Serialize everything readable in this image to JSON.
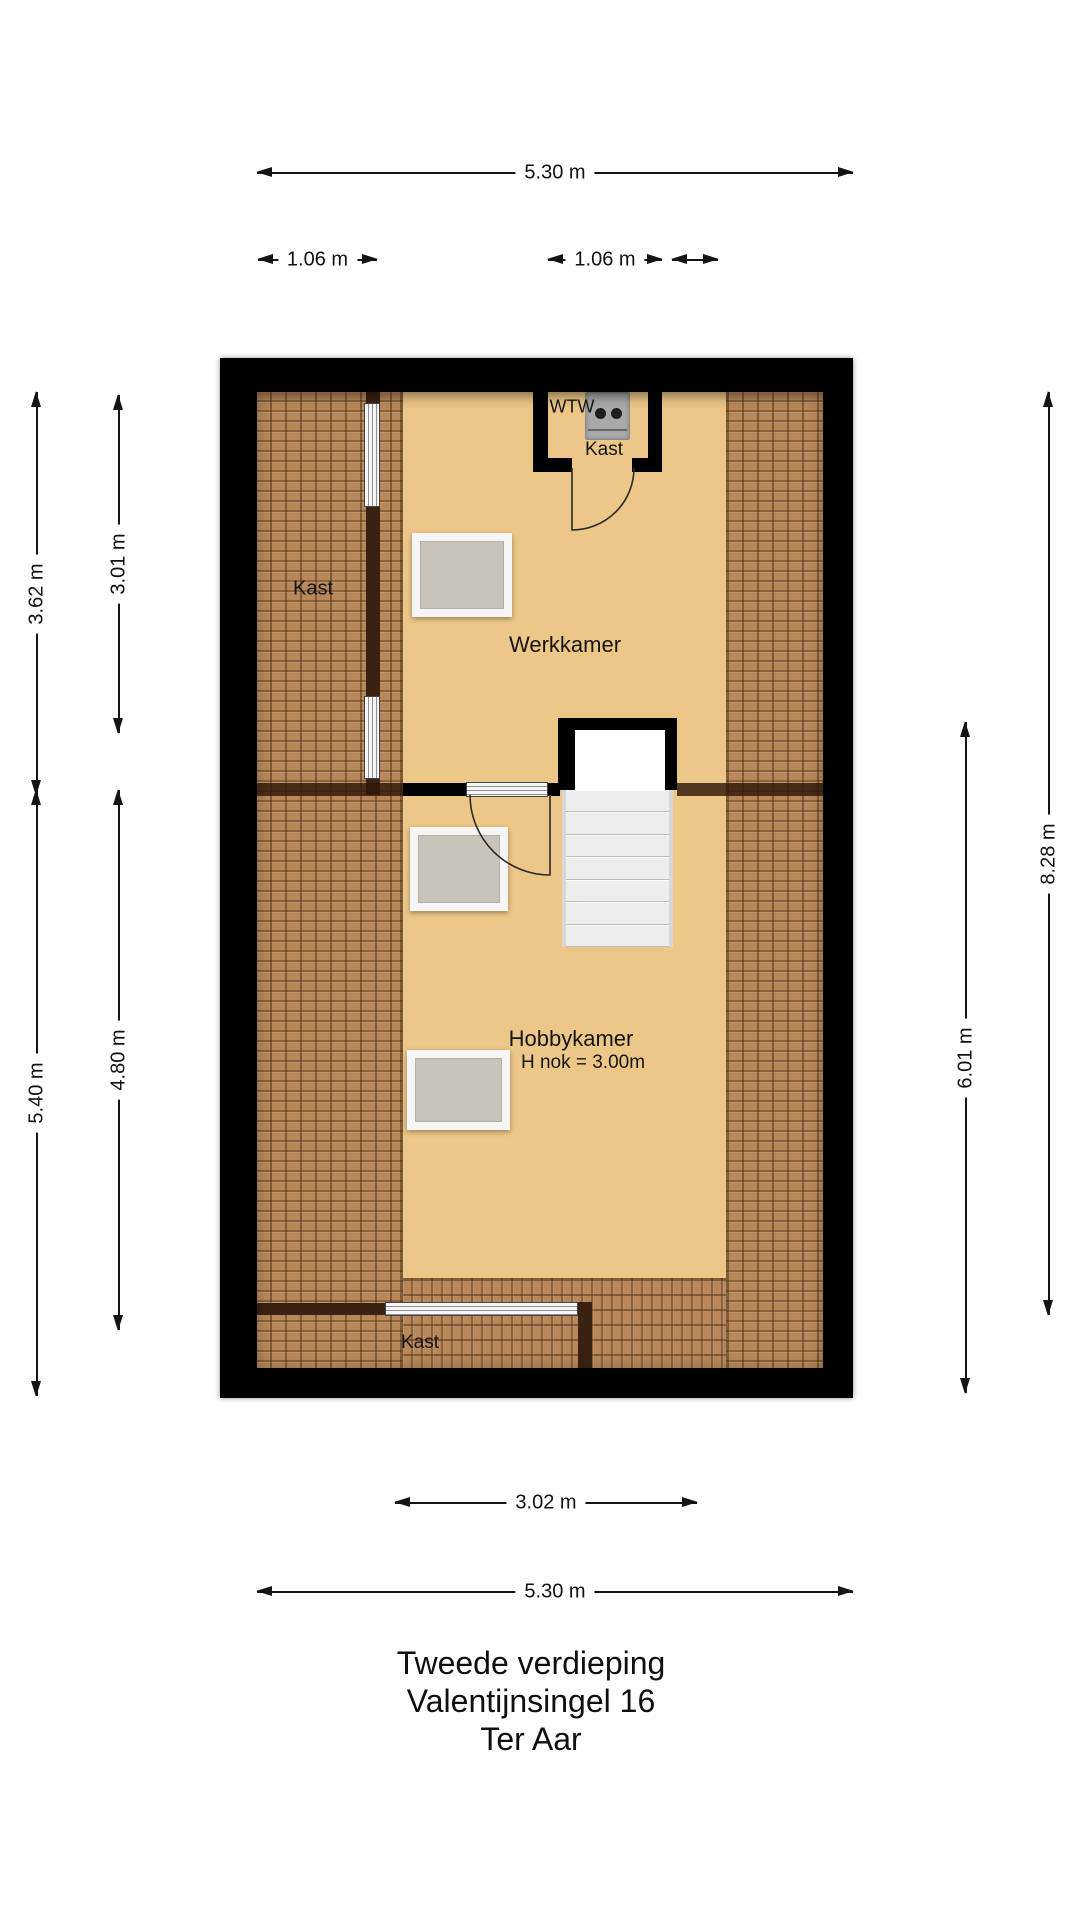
{
  "title": {
    "floor": "Tweede verdieping",
    "address": "Valentijnsingel 16",
    "city": "Ter Aar"
  },
  "rooms": {
    "kast_left": "Kast",
    "kast_top": "Kast",
    "kast_bottom": "Kast",
    "werkkamer": "Werkkamer",
    "hobbykamer": "Hobbykamer",
    "hobby_ridge_height": "H nok = 3.00m",
    "wtw_unit": "WTW"
  },
  "dimensions": {
    "top_width": "5.30 m",
    "top_small_left": "1.06 m",
    "top_small_right": "1.06 m",
    "left_upper_outer": "3.62 m",
    "left_upper_inner": "3.01 m",
    "left_lower_outer": "5.40 m",
    "left_lower_inner": "4.80 m",
    "right_outer": "8.28 m",
    "right_inner": "6.01 m",
    "bottom_room": "3.02 m",
    "bottom_width": "5.30 m"
  },
  "colors": {
    "wall": "#000000",
    "floor": "#edc787",
    "tiles": "#b8885a",
    "dark": "#3a2212",
    "skylight": "#c9c4ba",
    "stair": "#ececec"
  }
}
